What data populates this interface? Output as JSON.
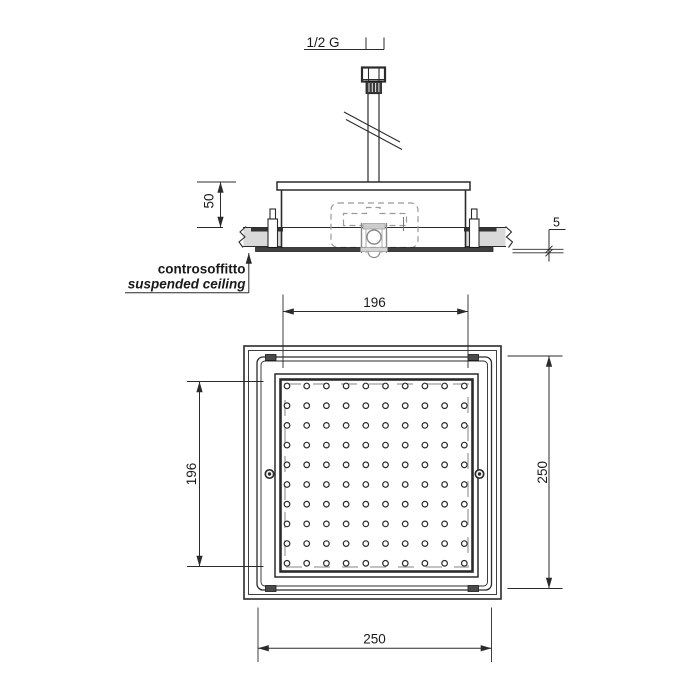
{
  "drawing": {
    "labels": {
      "thread_size": "1/2 G",
      "ceiling_label_it": "controsoffitto",
      "ceiling_label_en": "suspended ceiling"
    },
    "dimensions": {
      "recess_depth": "50",
      "plate_thickness": "5",
      "spray_face_width": "196",
      "spray_face_height": "196",
      "plate_height": "250",
      "plate_width": "250"
    },
    "nozzle_grid": {
      "rows": 10,
      "cols": 10
    },
    "colors": {
      "line": "#2b2b2b",
      "ceiling_fill": "#d9d9d9",
      "hidden_detail": "#9a9a9a",
      "plate_fill": "#3f3f3f"
    }
  }
}
